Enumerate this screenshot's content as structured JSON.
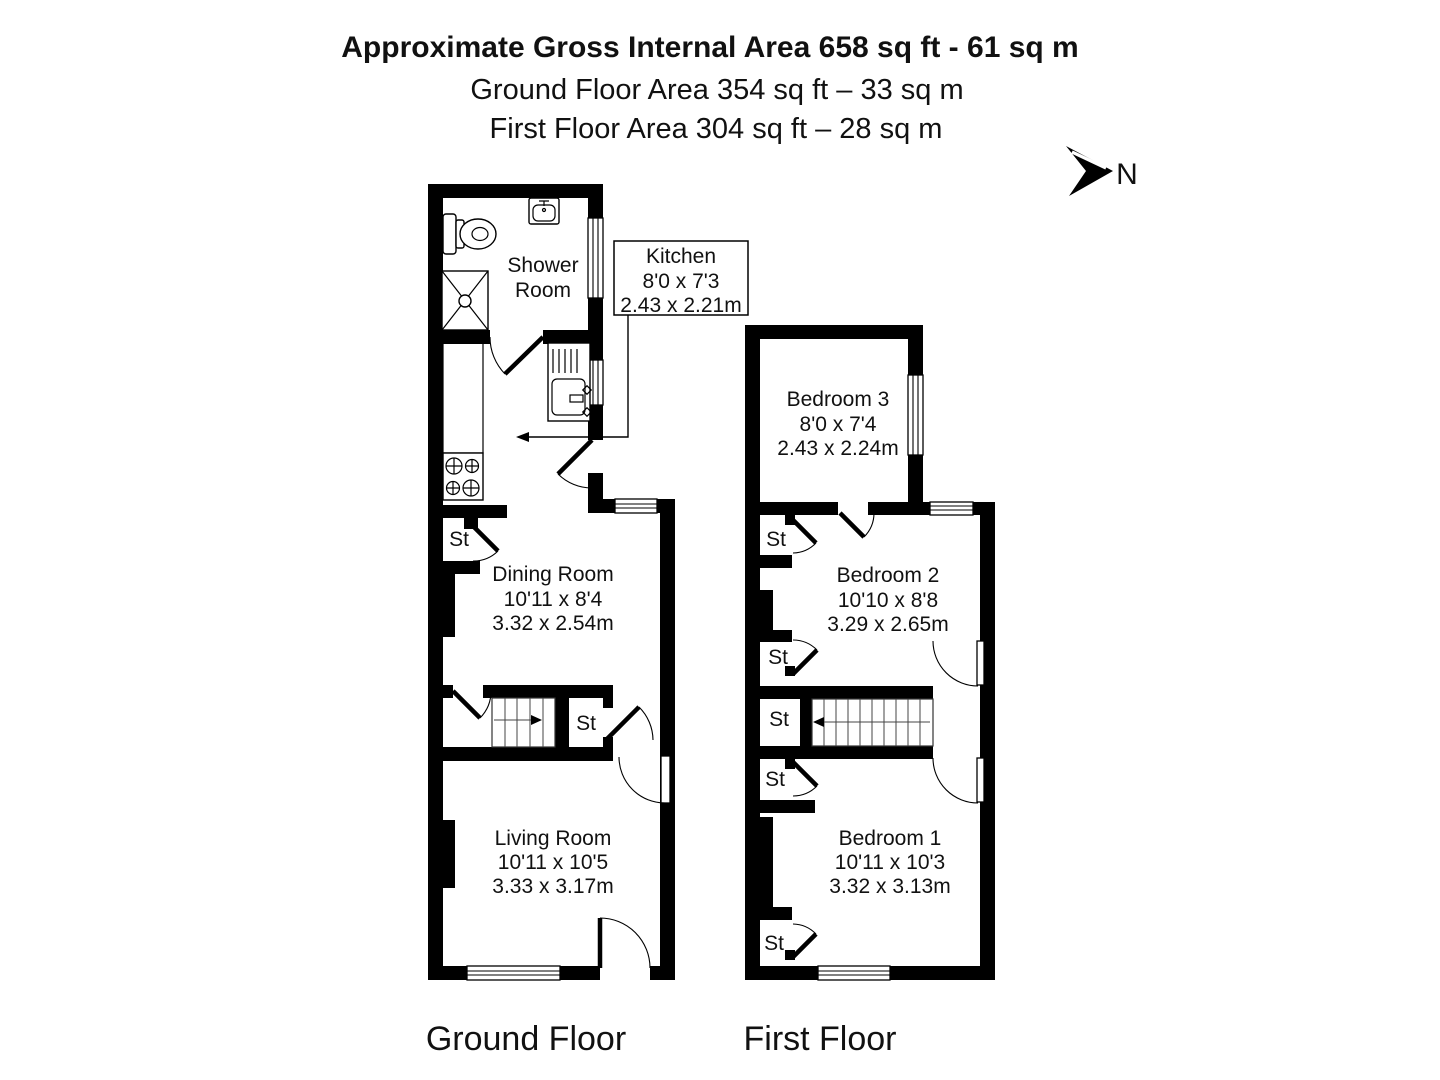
{
  "page": {
    "background": "#ffffff",
    "ink": "#000000"
  },
  "header": {
    "line1": "Approximate Gross Internal Area 658 sq ft - 61 sq m",
    "line2": "Ground Floor Area 354 sq ft – 33 sq m",
    "line3": "First Floor Area 304 sq ft – 28 sq m"
  },
  "compass": {
    "label": "N"
  },
  "ground_floor": {
    "caption": "Ground Floor",
    "shower_room": {
      "line1": "Shower",
      "line2": "Room"
    },
    "kitchen": {
      "name": "Kitchen",
      "imperial": "8'0 x 7'3",
      "metric": "2.43 x 2.21m"
    },
    "dining_room": {
      "name": "Dining Room",
      "imperial": "10'11 x 8'4",
      "metric": "3.32 x 2.54m"
    },
    "living_room": {
      "name": "Living Room",
      "imperial": "10'11 x 10'5",
      "metric": "3.33 x 3.17m"
    },
    "store1": "St",
    "store2": "St"
  },
  "first_floor": {
    "caption": "First Floor",
    "bedroom3": {
      "name": "Bedroom 3",
      "imperial": "8'0 x 7'4",
      "metric": "2.43 x 2.24m"
    },
    "bedroom2": {
      "name": "Bedroom 2",
      "imperial": "10'10 x 8'8",
      "metric": "3.29 x 2.65m"
    },
    "bedroom1": {
      "name": "Bedroom 1",
      "imperial": "10'11 x 10'3",
      "metric": "3.32 x 3.13m"
    },
    "store1": "St",
    "store2": "St",
    "store3": "St",
    "store4": "St",
    "store5": "St"
  }
}
